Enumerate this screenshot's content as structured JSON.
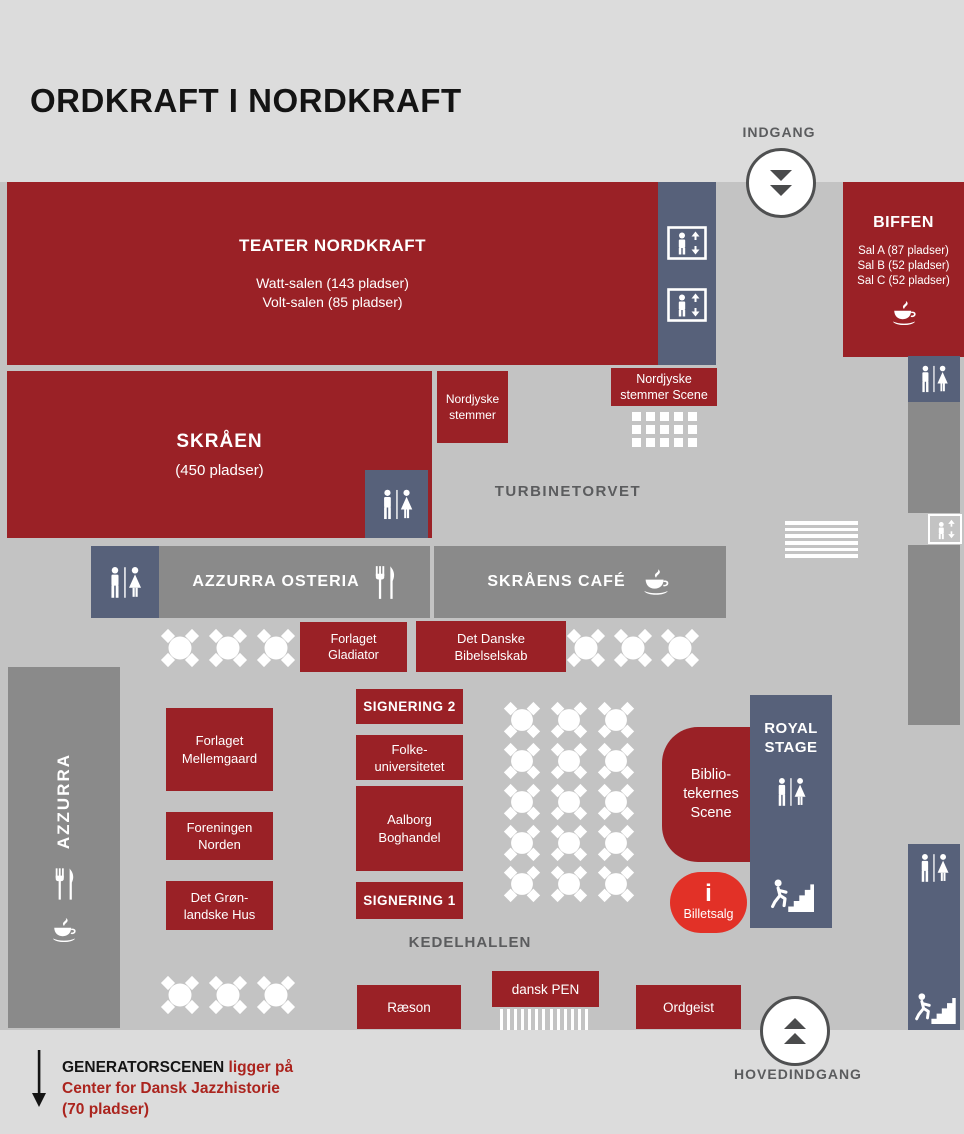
{
  "title": "ORDKRAFT I NORDKRAFT",
  "entrances": {
    "indgang_label": "INDGANG",
    "hovedindgang_label": "HOVEDINDGANG"
  },
  "areas": {
    "teater_nordkraft": {
      "name": "TEATER NORDKRAFT",
      "details": "Watt-salen (143 pladser)\nVolt-salen (85 pladser)"
    },
    "biffen": {
      "name": "BIFFEN",
      "details": "Sal A (87 pladser)\nSal B (52 pladser)\nSal C (52 pladser)"
    },
    "skraaen": {
      "name": "SKRÅEN",
      "capacity": "(450 pladser)"
    },
    "nordjyske_stemmer": {
      "name": "Nordjyske\nstemmer"
    },
    "nordjyske_stemmer_scene": {
      "name": "Nordjyske\nstemmer Scene"
    },
    "turbinetorvet": {
      "name": "TURBINETORVET"
    },
    "azzurra_osteria": {
      "name": "AZZURRA OSTERIA"
    },
    "skraaens_cafe": {
      "name": "SKRÅENS CAFÉ"
    },
    "azzurra": {
      "name": "AZZURRA"
    },
    "forlaget_gladiator": {
      "name": "Forlaget\nGladiator"
    },
    "det_danske_bibelselskab": {
      "name": "Det Danske\nBibelselskab"
    },
    "forlaget_mellemgaard": {
      "name": "Forlaget\nMellemgaard"
    },
    "foreningen_norden": {
      "name": "Foreningen\nNorden"
    },
    "det_groenlandske_hus": {
      "name": "Det Grøn-\nlandske Hus"
    },
    "signering_2": {
      "name": "SIGNERING 2"
    },
    "folkeuniversitetet": {
      "name": "Folke-\nuniversitetet"
    },
    "aalborg_boghandel": {
      "name": "Aalborg\nBoghandel"
    },
    "signering_1": {
      "name": "SIGNERING 1"
    },
    "kedelhallen": {
      "name": "KEDELHALLEN"
    },
    "bibliotekernes_scene": {
      "name": "Biblio-\ntekernes\nScene"
    },
    "royal_stage": {
      "name": "ROYAL\nSTAGE"
    },
    "billetsalg": {
      "info_symbol": "i",
      "name": "Billetsalg"
    },
    "raeson": {
      "name": "Ræson"
    },
    "dansk_pen": {
      "name": "dansk PEN"
    },
    "ordgeist": {
      "name": "Ordgeist"
    }
  },
  "footnote": {
    "venue": "GENERATORSCENEN",
    "text_after": "ligger på",
    "line2": "Center for Dansk Jazzhistorie",
    "line3": "(70 pladser)"
  },
  "colors": {
    "dark_red": "#9a2126",
    "bright_red": "#e23127",
    "slate_blue": "#57617a",
    "bar_gray": "#8a8a8a",
    "floor_gray": "#c3c3c3",
    "page_bg": "#dcdcdc",
    "label_gray": "#5b5c5e",
    "footnote_red": "#ab241e"
  }
}
